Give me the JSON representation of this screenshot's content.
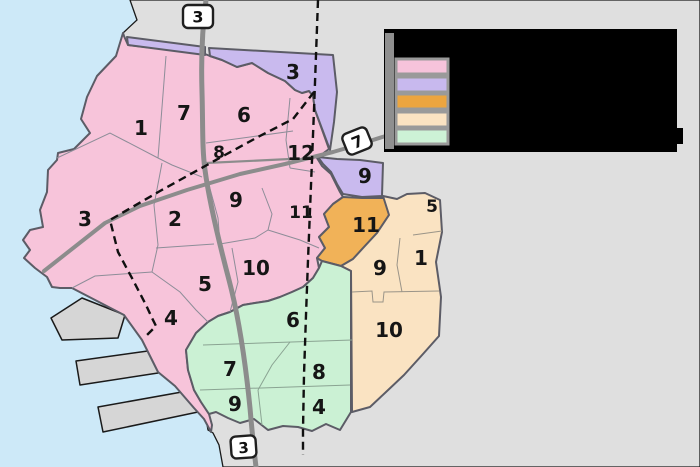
{
  "map": {
    "water_color": "#cde9f8",
    "land_color": "#dfdfdf",
    "pier_color": "#d6d6d6",
    "road_color": "#8c8c8c",
    "boundary_color": "#5c5c66",
    "wards": {
      "pink": {
        "color": "#f7c4da",
        "districts": [
          {
            "label": "1",
            "x": 141,
            "y": 128
          },
          {
            "label": "7",
            "x": 184,
            "y": 113
          },
          {
            "label": "6",
            "x": 244,
            "y": 115
          },
          {
            "label": "8",
            "x": 219,
            "y": 153,
            "small": true
          },
          {
            "label": "12",
            "x": 301,
            "y": 153
          },
          {
            "label": "9",
            "x": 236,
            "y": 200
          },
          {
            "label": "2",
            "x": 175,
            "y": 219
          },
          {
            "label": "11",
            "x": 301,
            "y": 213,
            "small": true
          },
          {
            "label": "3",
            "x": 85,
            "y": 219
          },
          {
            "label": "10",
            "x": 256,
            "y": 268
          },
          {
            "label": "5",
            "x": 205,
            "y": 284
          },
          {
            "label": "4",
            "x": 171,
            "y": 318
          }
        ]
      },
      "purple": {
        "color": "#c9baee",
        "districts": [
          {
            "label": "3",
            "x": 293,
            "y": 72
          },
          {
            "label": "9",
            "x": 365,
            "y": 176
          }
        ]
      },
      "orange": {
        "color": "#f1b258",
        "districts": [
          {
            "label": "11",
            "x": 366,
            "y": 225
          }
        ]
      },
      "cream": {
        "color": "#fae3c2",
        "districts": [
          {
            "label": "5",
            "x": 432,
            "y": 207,
            "small": true
          },
          {
            "label": "1",
            "x": 421,
            "y": 258
          },
          {
            "label": "9",
            "x": 380,
            "y": 268
          },
          {
            "label": "10",
            "x": 389,
            "y": 330
          }
        ]
      },
      "green": {
        "color": "#cbf1d4",
        "districts": [
          {
            "label": "6",
            "x": 293,
            "y": 320
          },
          {
            "label": "7",
            "x": 230,
            "y": 369
          },
          {
            "label": "8",
            "x": 319,
            "y": 372
          },
          {
            "label": "9",
            "x": 235,
            "y": 404
          },
          {
            "label": "4",
            "x": 319,
            "y": 407
          }
        ]
      }
    },
    "route_markers": [
      {
        "label": "3"
      },
      {
        "label": "7"
      },
      {
        "label": "3"
      }
    ],
    "legend": {
      "bg_color": "#000000",
      "side_strip_color": "#8f8f8f",
      "swatch_colors": [
        "#f6c3db",
        "#c8b9ee",
        "#eca53f",
        "#fbe3c2",
        "#cdf2d6"
      ]
    }
  }
}
